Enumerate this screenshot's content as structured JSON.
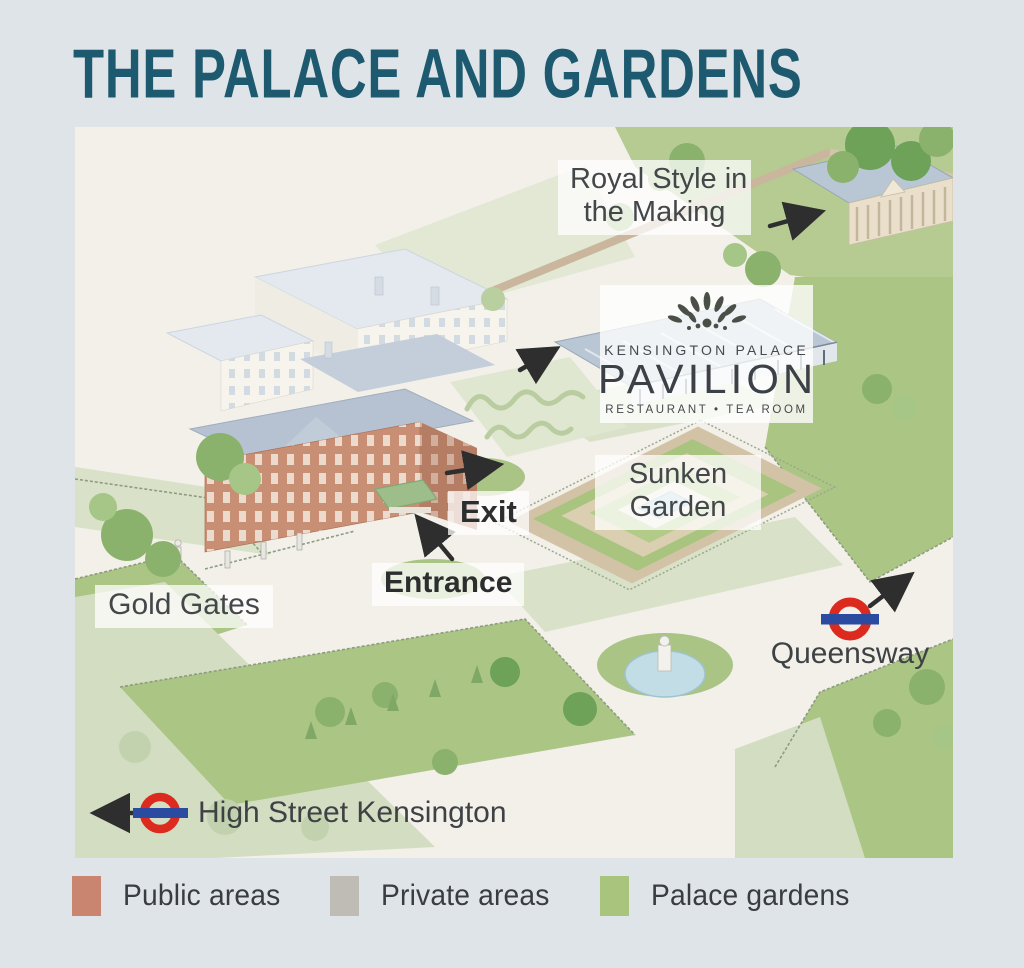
{
  "page": {
    "title": "THE PALACE AND GARDENS",
    "title_color": "#1d5a70",
    "background_color": "#dfe4e9",
    "map_background_color": "#f2f0e9"
  },
  "map": {
    "labels": {
      "royal_style_line1": "Royal Style in",
      "royal_style_line2": "the Making",
      "sunken_garden_line1": "Sunken",
      "sunken_garden_line2": "Garden",
      "exit": "Exit",
      "entrance": "Entrance",
      "gold_gates": "Gold Gates"
    },
    "pavilion_logo": {
      "brand": "KENSINGTON PALACE",
      "name": "PAVILION",
      "subtitle": "RESTAURANT • TEA ROOM"
    },
    "stations": [
      {
        "name": "Queensway"
      },
      {
        "name": "High Street Kensington"
      }
    ],
    "roundel_colors": {
      "ring": "#dc2a1e",
      "bar": "#2a4b9f"
    },
    "arrow_color": "#2e2e2e"
  },
  "legend": {
    "items": [
      {
        "label": "Public areas",
        "color": "#c98570"
      },
      {
        "label": "Private areas",
        "color": "#bfbcb6"
      },
      {
        "label": "Palace gardens",
        "color": "#a9c47d"
      }
    ]
  }
}
